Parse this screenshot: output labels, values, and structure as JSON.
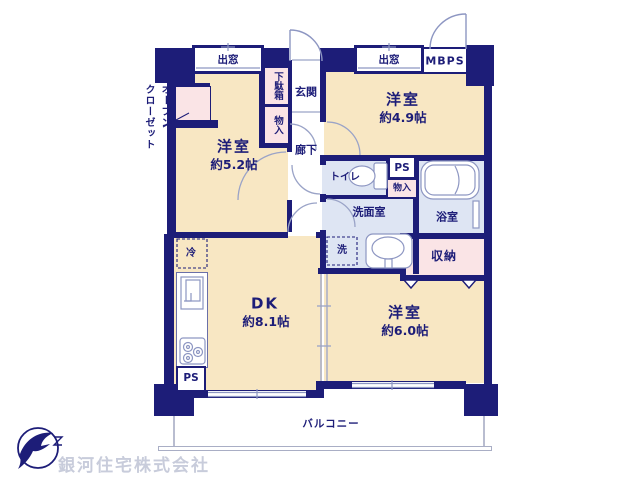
{
  "plan": {
    "rooms": {
      "western_5_2": {
        "name": "洋室",
        "size": "約5.2帖"
      },
      "western_4_9": {
        "name": "洋室",
        "size": "約4.9帖"
      },
      "western_6_0": {
        "name": "洋室",
        "size": "約6.0帖"
      },
      "dk": {
        "name": "DK",
        "size": "約8.1帖"
      },
      "entrance": "玄関",
      "hallway": "廊下",
      "toilet": "トイレ",
      "washroom": "洗面室",
      "bathroom": "浴室",
      "storage": "収納",
      "balcony": "バルコニー"
    },
    "labels": {
      "bay_window": "出窓",
      "mbps": "MBPS",
      "open_closet_1": "オープン",
      "open_closet_2": "クローゼット",
      "shoe_box": "下駄箱",
      "storage_small": "物入",
      "pipe_space": "PS",
      "fridge": "冷",
      "washer": "洗"
    },
    "colors": {
      "wall": "#1d1d78",
      "room_floor": "#f8e7c3",
      "wet_floor": "#dee5f3",
      "closet_floor": "#fae4e6",
      "fixture_outline": "#8d96c2"
    }
  },
  "footer": {
    "company_name": "銀河住宅株式会社"
  }
}
